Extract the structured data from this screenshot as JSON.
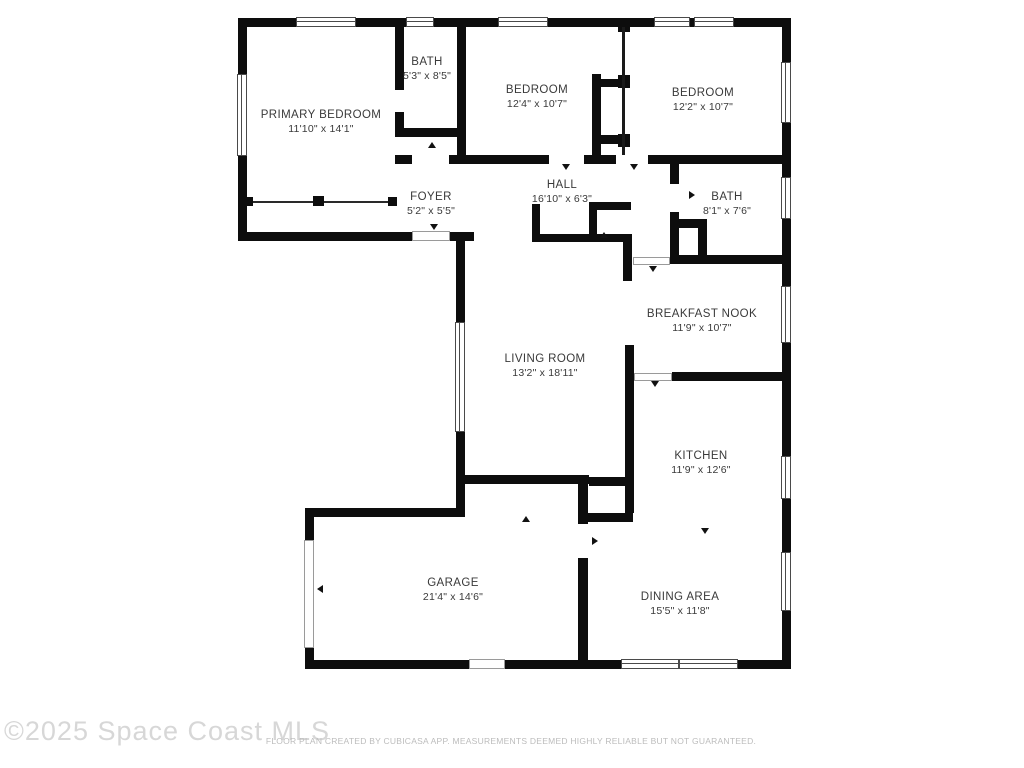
{
  "watermark": "©2025 Space Coast MLS",
  "disclaimer": "FLOOR PLAN CREATED BY CUBICASA APP. MEASUREMENTS DEEMED HIGHLY RELIABLE BUT NOT GUARANTEED.",
  "colors": {
    "wall": "#0d0d0d",
    "label": "#3a3a3a",
    "watermark": "#d7d7d7",
    "disclaimer": "#bcbcbc"
  },
  "rooms": [
    {
      "id": "primary-bedroom",
      "name": "PRIMARY BEDROOM",
      "dims": "11'10\" x 14'1\"",
      "x": 321,
      "y": 122
    },
    {
      "id": "bath-1",
      "name": "BATH",
      "dims": "5'3\" x 8'5\"",
      "x": 427,
      "y": 69
    },
    {
      "id": "bedroom-1",
      "name": "BEDROOM",
      "dims": "12'4\" x 10'7\"",
      "x": 537,
      "y": 97
    },
    {
      "id": "bedroom-2",
      "name": "BEDROOM",
      "dims": "12'2\" x 10'7\"",
      "x": 703,
      "y": 100
    },
    {
      "id": "foyer",
      "name": "FOYER",
      "dims": "5'2\" x 5'5\"",
      "x": 431,
      "y": 204
    },
    {
      "id": "hall",
      "name": "HALL",
      "dims": "16'10\" x 6'3\"",
      "x": 562,
      "y": 192
    },
    {
      "id": "bath-2",
      "name": "BATH",
      "dims": "8'1\" x 7'6\"",
      "x": 727,
      "y": 204
    },
    {
      "id": "breakfast-nook",
      "name": "BREAKFAST NOOK",
      "dims": "11'9\" x 10'7\"",
      "x": 702,
      "y": 321
    },
    {
      "id": "living-room",
      "name": "LIVING ROOM",
      "dims": "13'2\" x 18'11\"",
      "x": 545,
      "y": 366
    },
    {
      "id": "kitchen",
      "name": "KITCHEN",
      "dims": "11'9\" x 12'6\"",
      "x": 701,
      "y": 463
    },
    {
      "id": "garage",
      "name": "GARAGE",
      "dims": "21'4\" x 14'6\"",
      "x": 453,
      "y": 590
    },
    {
      "id": "dining-area",
      "name": "DINING AREA",
      "dims": "15'5\" x 11'8\"",
      "x": 680,
      "y": 604
    }
  ],
  "floorplan": {
    "walls": [
      [
        238,
        18,
        552,
        9
      ],
      [
        238,
        18,
        9,
        223
      ],
      [
        238,
        232,
        174,
        9
      ],
      [
        450,
        232,
        24,
        9
      ],
      [
        456,
        232,
        9,
        92
      ],
      [
        456,
        430,
        9,
        82
      ],
      [
        305,
        508,
        160,
        9
      ],
      [
        305,
        508,
        9,
        32
      ],
      [
        305,
        648,
        9,
        21
      ],
      [
        305,
        660,
        164,
        9
      ],
      [
        505,
        660,
        285,
        9
      ],
      [
        782,
        18,
        9,
        651
      ],
      [
        395,
        26,
        9,
        64
      ],
      [
        395,
        112,
        9,
        25
      ],
      [
        395,
        128,
        70,
        9
      ],
      [
        457,
        26,
        9,
        137
      ],
      [
        395,
        155,
        17,
        9
      ],
      [
        449,
        155,
        100,
        9
      ],
      [
        584,
        155,
        32,
        9
      ],
      [
        648,
        155,
        134,
        9
      ],
      [
        618,
        18,
        12,
        14
      ],
      [
        592,
        74,
        9,
        87
      ],
      [
        592,
        79,
        30,
        8
      ],
      [
        618,
        75,
        12,
        13
      ],
      [
        592,
        135,
        30,
        9
      ],
      [
        618,
        134,
        12,
        13
      ],
      [
        670,
        157,
        9,
        27
      ],
      [
        670,
        212,
        9,
        47
      ],
      [
        670,
        219,
        37,
        9
      ],
      [
        698,
        228,
        9,
        31
      ],
      [
        670,
        255,
        112,
        9
      ],
      [
        532,
        204,
        8,
        38
      ],
      [
        532,
        234,
        92,
        8
      ],
      [
        589,
        202,
        8,
        40
      ],
      [
        589,
        202,
        42,
        8
      ],
      [
        623,
        234,
        9,
        47
      ],
      [
        625,
        345,
        9,
        139
      ],
      [
        672,
        372,
        110,
        9
      ],
      [
        456,
        475,
        133,
        9
      ],
      [
        589,
        477,
        44,
        9
      ],
      [
        583,
        513,
        50,
        9
      ],
      [
        625,
        484,
        9,
        29
      ],
      [
        578,
        475,
        10,
        49
      ],
      [
        578,
        558,
        10,
        111
      ]
    ],
    "thin_walls": [
      [
        622,
        27,
        3,
        128
      ]
    ],
    "windows": [
      {
        "r": [
          296,
          17,
          60,
          10
        ],
        "o": "h"
      },
      {
        "r": [
          406,
          17,
          28,
          10
        ],
        "o": "h"
      },
      {
        "r": [
          498,
          17,
          50,
          10
        ],
        "o": "h"
      },
      {
        "r": [
          654,
          17,
          36,
          10
        ],
        "o": "h"
      },
      {
        "r": [
          694,
          17,
          40,
          10
        ],
        "o": "h"
      },
      {
        "r": [
          237,
          74,
          10,
          82
        ],
        "o": "v"
      },
      {
        "r": [
          455,
          322,
          10,
          110
        ],
        "o": "v"
      },
      {
        "r": [
          781,
          62,
          10,
          61
        ],
        "o": "v"
      },
      {
        "r": [
          781,
          177,
          10,
          42
        ],
        "o": "v"
      },
      {
        "r": [
          781,
          286,
          10,
          57
        ],
        "o": "v"
      },
      {
        "r": [
          781,
          456,
          10,
          43
        ],
        "o": "v"
      },
      {
        "r": [
          781,
          552,
          10,
          59
        ],
        "o": "v"
      },
      {
        "r": [
          621,
          659,
          58,
          10
        ],
        "o": "h"
      },
      {
        "r": [
          679,
          659,
          59,
          10
        ],
        "o": "h"
      }
    ],
    "doors": [
      [
        412,
        231,
        38,
        10
      ],
      [
        304,
        540,
        10,
        108
      ],
      [
        469,
        659,
        36,
        10
      ],
      [
        633,
        257,
        37,
        8
      ],
      [
        634,
        373,
        38,
        8
      ]
    ],
    "closet_lines": [
      [
        247,
        201,
        149,
        2
      ]
    ],
    "closet_squares": [
      [
        244,
        197,
        9,
        9
      ],
      [
        313,
        196,
        11,
        10
      ],
      [
        388,
        197,
        9,
        9
      ]
    ],
    "ticks": [
      {
        "x": 428,
        "y": 142,
        "rot": 0
      },
      {
        "x": 562,
        "y": 164,
        "rot": 180
      },
      {
        "x": 630,
        "y": 164,
        "rot": 180
      },
      {
        "x": 688,
        "y": 192,
        "rot": 90
      },
      {
        "x": 430,
        "y": 224,
        "rot": 180
      },
      {
        "x": 600,
        "y": 232,
        "rot": 0
      },
      {
        "x": 649,
        "y": 266,
        "rot": 180
      },
      {
        "x": 651,
        "y": 381,
        "rot": 180
      },
      {
        "x": 591,
        "y": 538,
        "rot": 90
      },
      {
        "x": 701,
        "y": 528,
        "rot": 180
      },
      {
        "x": 316,
        "y": 586,
        "rot": 270
      },
      {
        "x": 522,
        "y": 516,
        "rot": 0
      }
    ]
  }
}
